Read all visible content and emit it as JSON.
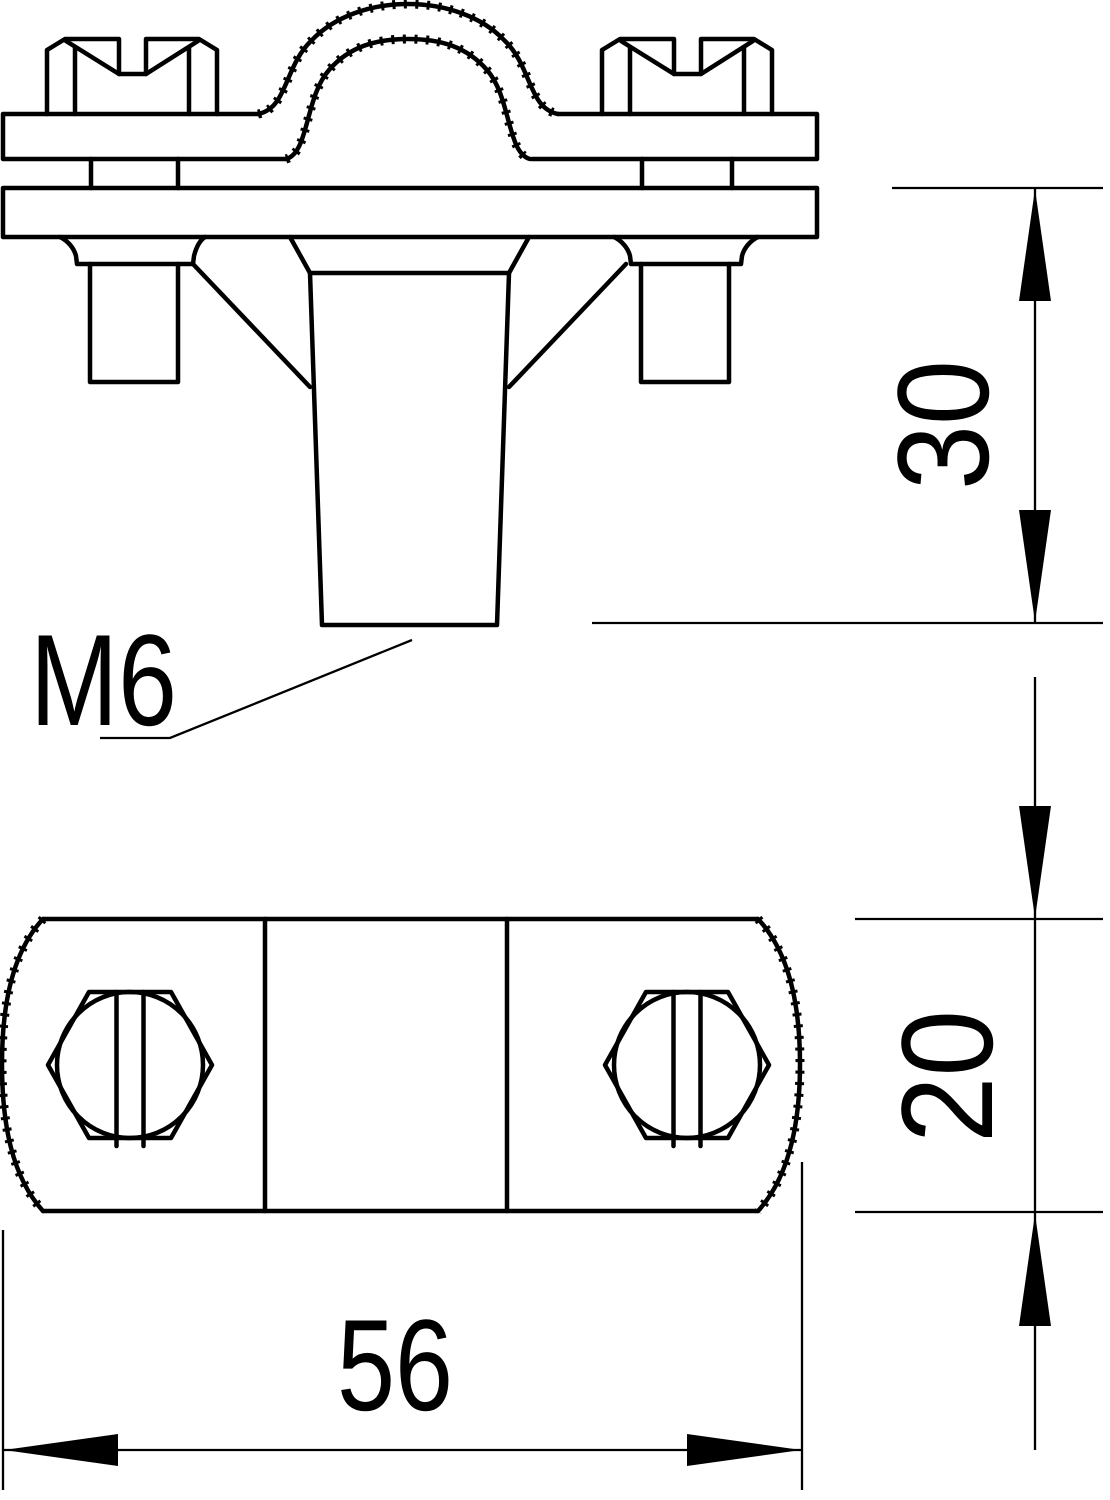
{
  "drawing": {
    "type": "technical-drawing",
    "colors": {
      "line": "#000000",
      "background": "#ffffff"
    },
    "dimensions": [
      {
        "id": "stud-length",
        "value": "30",
        "orientation": "vertical"
      },
      {
        "id": "body-width",
        "value": "20",
        "orientation": "vertical"
      },
      {
        "id": "body-length",
        "value": "56",
        "orientation": "horizontal"
      }
    ],
    "annotations": [
      {
        "id": "thread-size",
        "text": "M6"
      }
    ]
  }
}
